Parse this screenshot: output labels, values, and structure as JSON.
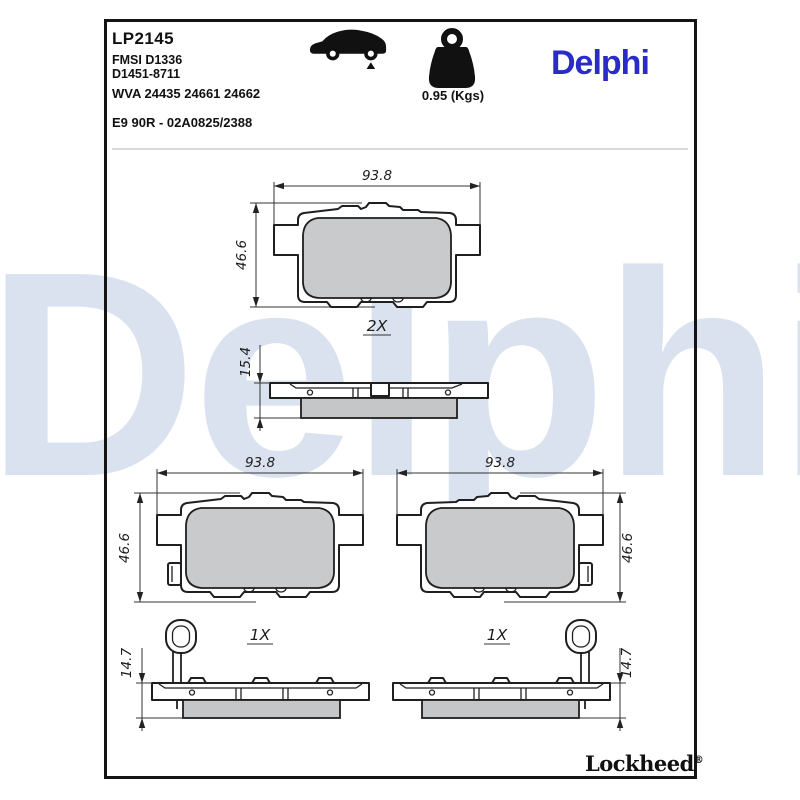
{
  "header": {
    "part_number": "LP2145",
    "fmsi_code": "FMSI D1336",
    "fmsi_code2": "D1451-8711",
    "wva_codes": "WVA 24435 24661 24662",
    "homologation": "E9 90R - 02A0825/2388"
  },
  "weight": {
    "value": "0.95 (Kgs)"
  },
  "icons": {
    "vehicle": "car-rear-axle-icon",
    "weight": "weight-icon"
  },
  "brand": {
    "logo_text": "Delphi",
    "logo_color": "#2B2BC8",
    "watermark_text": "Delphi",
    "watermark_color": "#DAE1EF",
    "footer_logo_text": "Lockheed",
    "footer_registered": "®"
  },
  "drawing": {
    "line_color": "#1F1F1F",
    "friction_color": "#C9CACC",
    "friction_side_color": "#C5C6C8",
    "top_pad": {
      "width": "93.8",
      "height": "46.6",
      "quantity": "2X"
    },
    "top_side": {
      "thickness": "15.4"
    },
    "bottom_left_pad": {
      "width": "93.8",
      "height": "46.6",
      "quantity": "1X"
    },
    "bottom_right_pad": {
      "width": "93.8",
      "height": "46.6",
      "quantity": "1X"
    },
    "bottom_left_side": {
      "thickness": "14.7"
    },
    "bottom_right_side": {
      "thickness": "14.7"
    }
  }
}
